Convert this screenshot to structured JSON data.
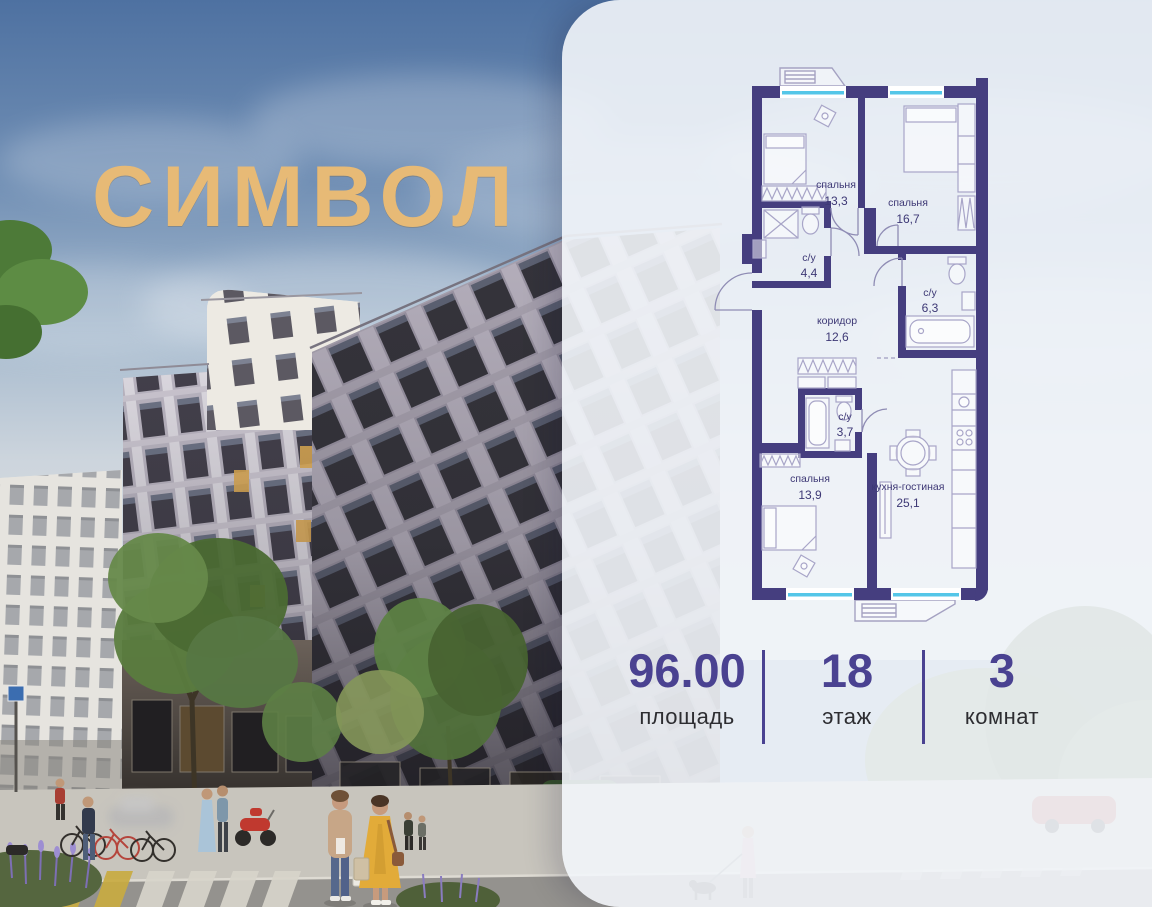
{
  "brand": {
    "name": "СИМВОЛ"
  },
  "panel": {
    "floor_plan": {
      "rooms": [
        {
          "name": "спальня",
          "area": "13,3"
        },
        {
          "name": "спальня",
          "area": "16,7"
        },
        {
          "name": "с/у",
          "area": "4,4"
        },
        {
          "name": "с/у",
          "area": "6,3"
        },
        {
          "name": "коридор",
          "area": "12,6"
        },
        {
          "name": "с/у",
          "area": "3,7"
        },
        {
          "name": "спальня",
          "area": "13,9"
        },
        {
          "name": "кухня-гостиная",
          "area": "25,1"
        }
      ]
    },
    "stats": [
      {
        "value": "96.00",
        "label": "площадь"
      },
      {
        "value": "18",
        "label": "этаж"
      },
      {
        "value": "3",
        "label": "комнат"
      }
    ]
  },
  "colors": {
    "accent": "#4a4291",
    "plan_wall": "#453e7f",
    "plan_window": "#54c6e8",
    "logo_gold": "#e7ba76"
  }
}
